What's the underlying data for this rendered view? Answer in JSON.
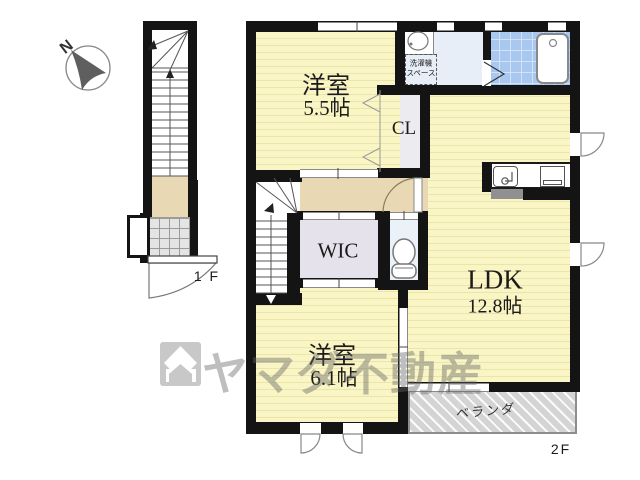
{
  "floor_plan": {
    "compass_label": "N",
    "floor1_label": "1 F",
    "floor2_label": "2F",
    "rooms": {
      "bedroom_top": {
        "name": "洋室",
        "size": "5.5帖"
      },
      "bedroom_bottom": {
        "name": "洋室",
        "size": "6.1帖"
      },
      "ldk": {
        "name": "LDK",
        "size": "12.8帖"
      },
      "closet": {
        "label": "CL"
      },
      "wic": {
        "label": "WIC"
      },
      "laundry": {
        "line1": "洗濯機",
        "line2": "スペース"
      },
      "veranda": {
        "label": "ベランダ"
      }
    },
    "watermark": {
      "brand": "ヤマダ不動産"
    },
    "colors": {
      "wall": "#141414",
      "room_yellow": "#f9f5c4",
      "hall_tan": "#e9d8b4",
      "wic_lavender": "#e6e2ec",
      "closet_gray": "#ecebf0",
      "washroom_blue": "#e7eef8",
      "bath_tile_blue": "#a9c8ef",
      "veranda_gray": "#d4d4d4",
      "watermark_gray": "#c9c9c9"
    }
  }
}
